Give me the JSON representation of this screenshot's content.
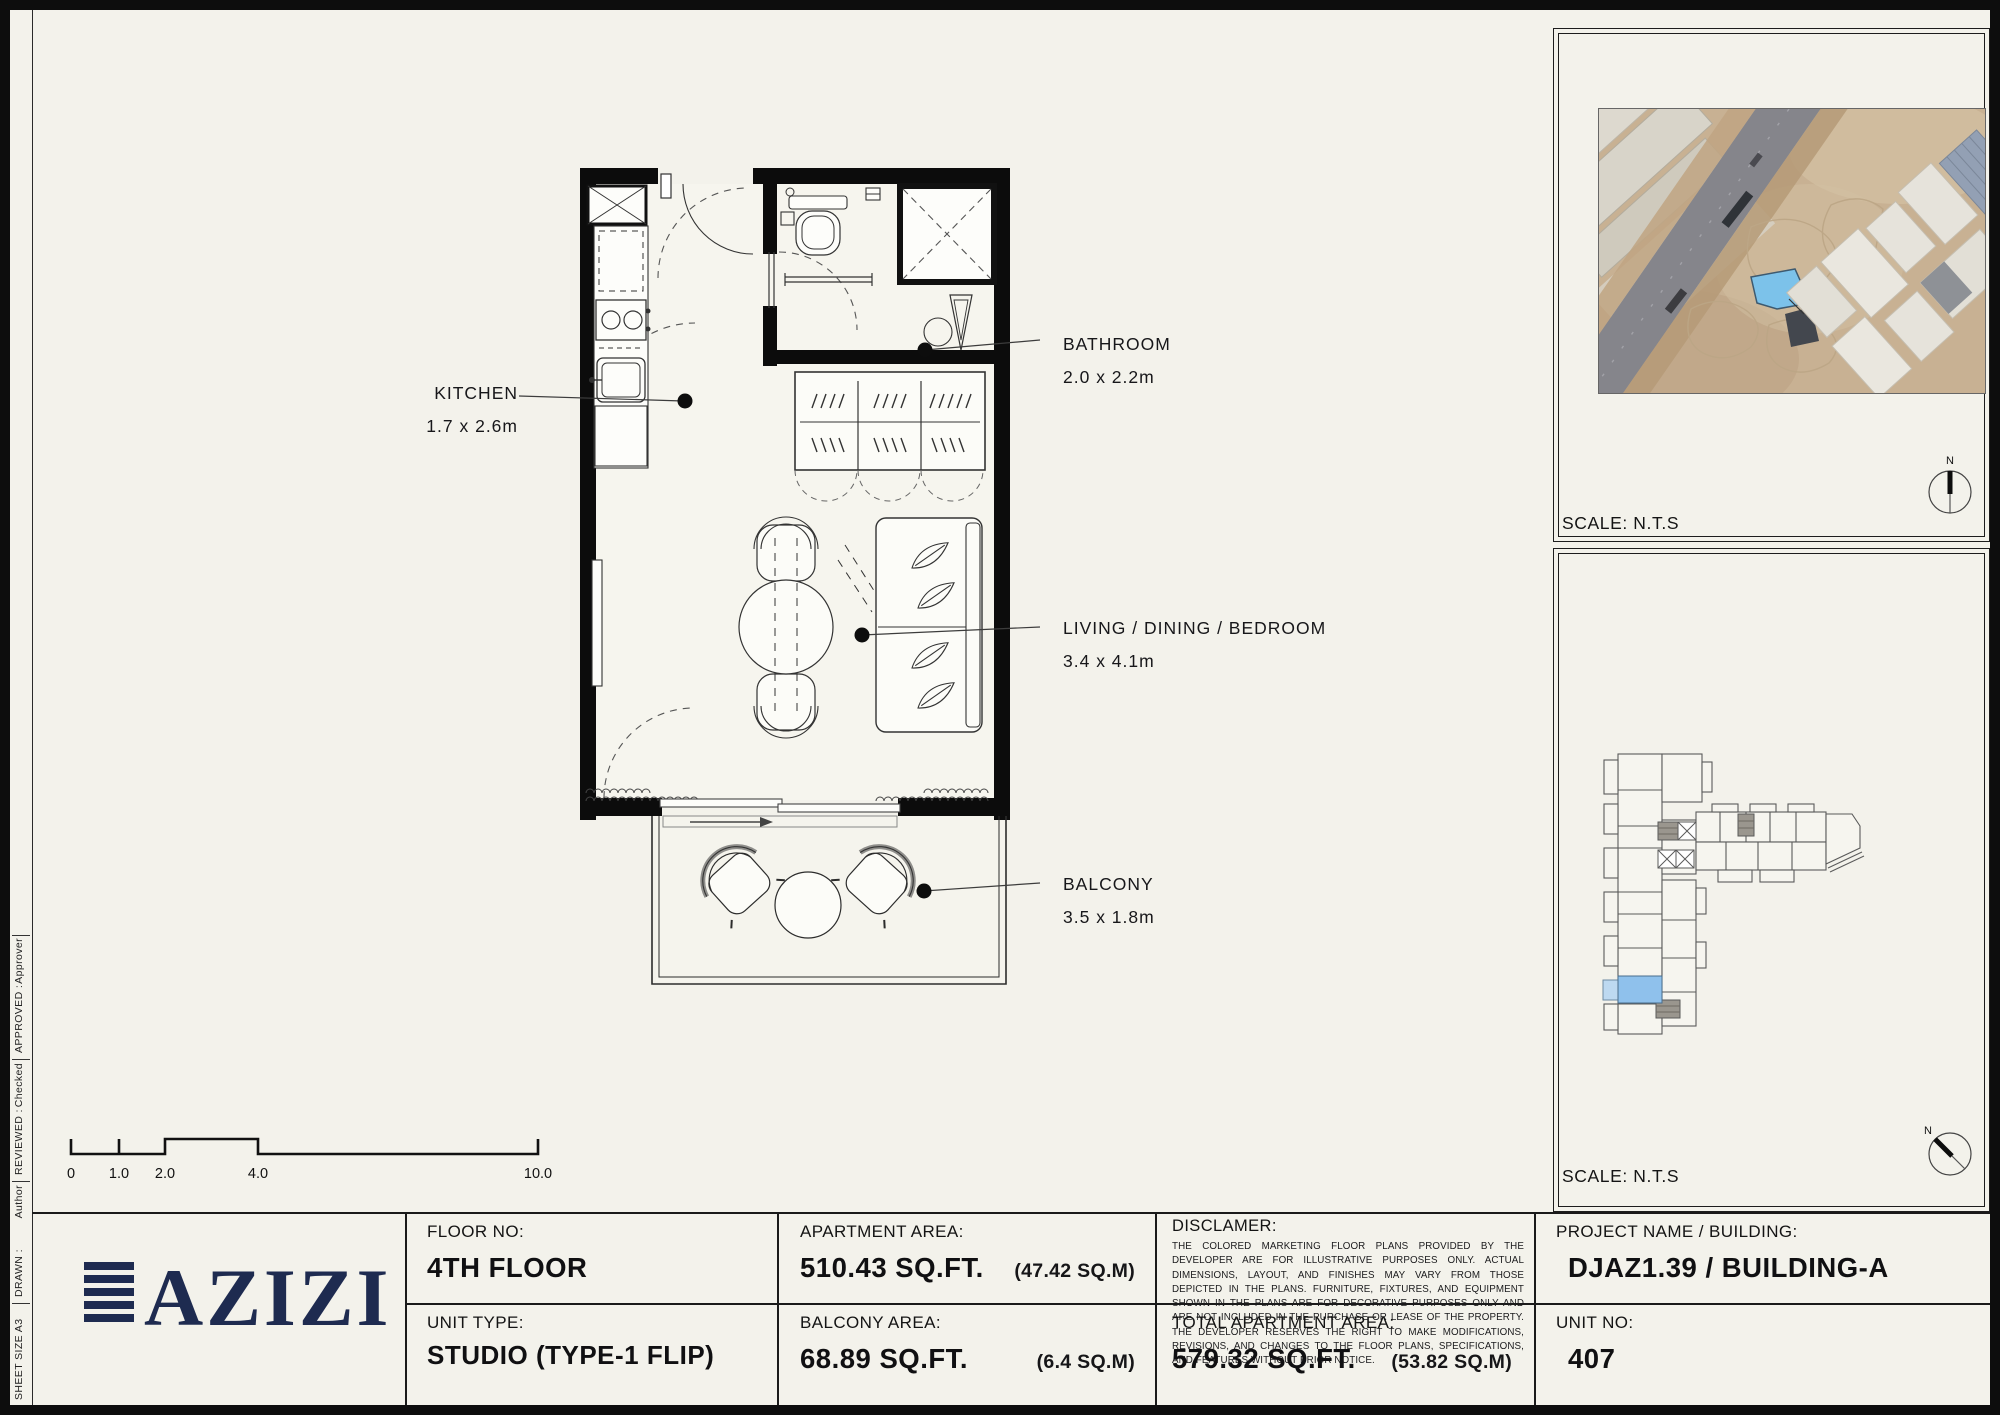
{
  "sheet": {
    "bg": "#f3f2eb",
    "ink": "#0d0d0d",
    "logo_navy": "#1e2b50",
    "highlight_blue": "#7cc2ea"
  },
  "sidebar": {
    "fields": [
      {
        "label": "SHEET SIZE A3",
        "value": ""
      },
      {
        "label": "DRAWN :",
        "value": "Author"
      },
      {
        "label": "REVIEWED :",
        "value": "Checked"
      },
      {
        "label": "APPROVED :",
        "value": "Approver"
      }
    ]
  },
  "plan": {
    "rooms": [
      {
        "name": "KITCHEN",
        "dims": "1.7 x 2.6m"
      },
      {
        "name": "BATHROOM",
        "dims": "2.0 x 2.2m"
      },
      {
        "name": "LIVING / DINING / BEDROOM",
        "dims": "3.4 x 4.1m"
      },
      {
        "name": "BALCONY",
        "dims": "3.5 x 1.8m"
      }
    ],
    "scale_bar_ticks": [
      "0",
      "1.0",
      "2.0",
      "4.0",
      "10.0"
    ]
  },
  "panels": {
    "site_map_scale": "SCALE: N.T.S",
    "key_plan_scale": "SCALE: N.T.S",
    "north": "N",
    "icons": [
      "north-compass-icon",
      "site-map-image",
      "key-plan-drawing"
    ]
  },
  "title_block": {
    "floor_label": "FLOOR NO:",
    "floor_value": "4TH FLOOR",
    "unit_type_label": "UNIT TYPE:",
    "unit_type_value": "STUDIO (TYPE-1 FLIP)",
    "apartment_area_label": "APARTMENT AREA:",
    "apartment_area_value": "510.43 SQ.FT.",
    "apartment_area_metric": "(47.42 SQ.M)",
    "balcony_area_label": "BALCONY AREA:",
    "balcony_area_value": "68.89 SQ.FT.",
    "balcony_area_metric": "(6.4 SQ.M)",
    "disclaimer_label": "DISCLAMER:",
    "disclaimer_text": "THE COLORED MARKETING FLOOR PLANS PROVIDED BY THE DEVELOPER ARE FOR ILLUSTRATIVE PURPOSES ONLY. ACTUAL DIMENSIONS, LAYOUT, AND FINISHES MAY VARY FROM THOSE DEPICTED IN THE PLANS. FURNITURE, FIXTURES, AND EQUIPMENT SHOWN IN THE PLANS ARE FOR DECORATIVE PURPOSES ONLY AND ARE NOT INCLUDED IN THE PURCHASE OR LEASE OF THE PROPERTY. THE DEVELOPER RESERVES THE RIGHT TO MAKE MODIFICATIONS, REVISIONS, AND CHANGES TO THE FLOOR PLANS, SPECIFICATIONS, AND FEATURES WITHOUT PRIOR NOTICE.",
    "total_area_label": "TOTAL APARTMENT AREA:",
    "total_area_value": "579.32 SQ.FT.",
    "total_area_metric": "(53.82 SQ.M)",
    "project_label": "PROJECT NAME / BUILDING:",
    "project_value": "DJAZ1.39 / BUILDING-A",
    "unit_no_label": "UNIT NO:",
    "unit_no_value": "407",
    "brand": "AZIZI"
  }
}
